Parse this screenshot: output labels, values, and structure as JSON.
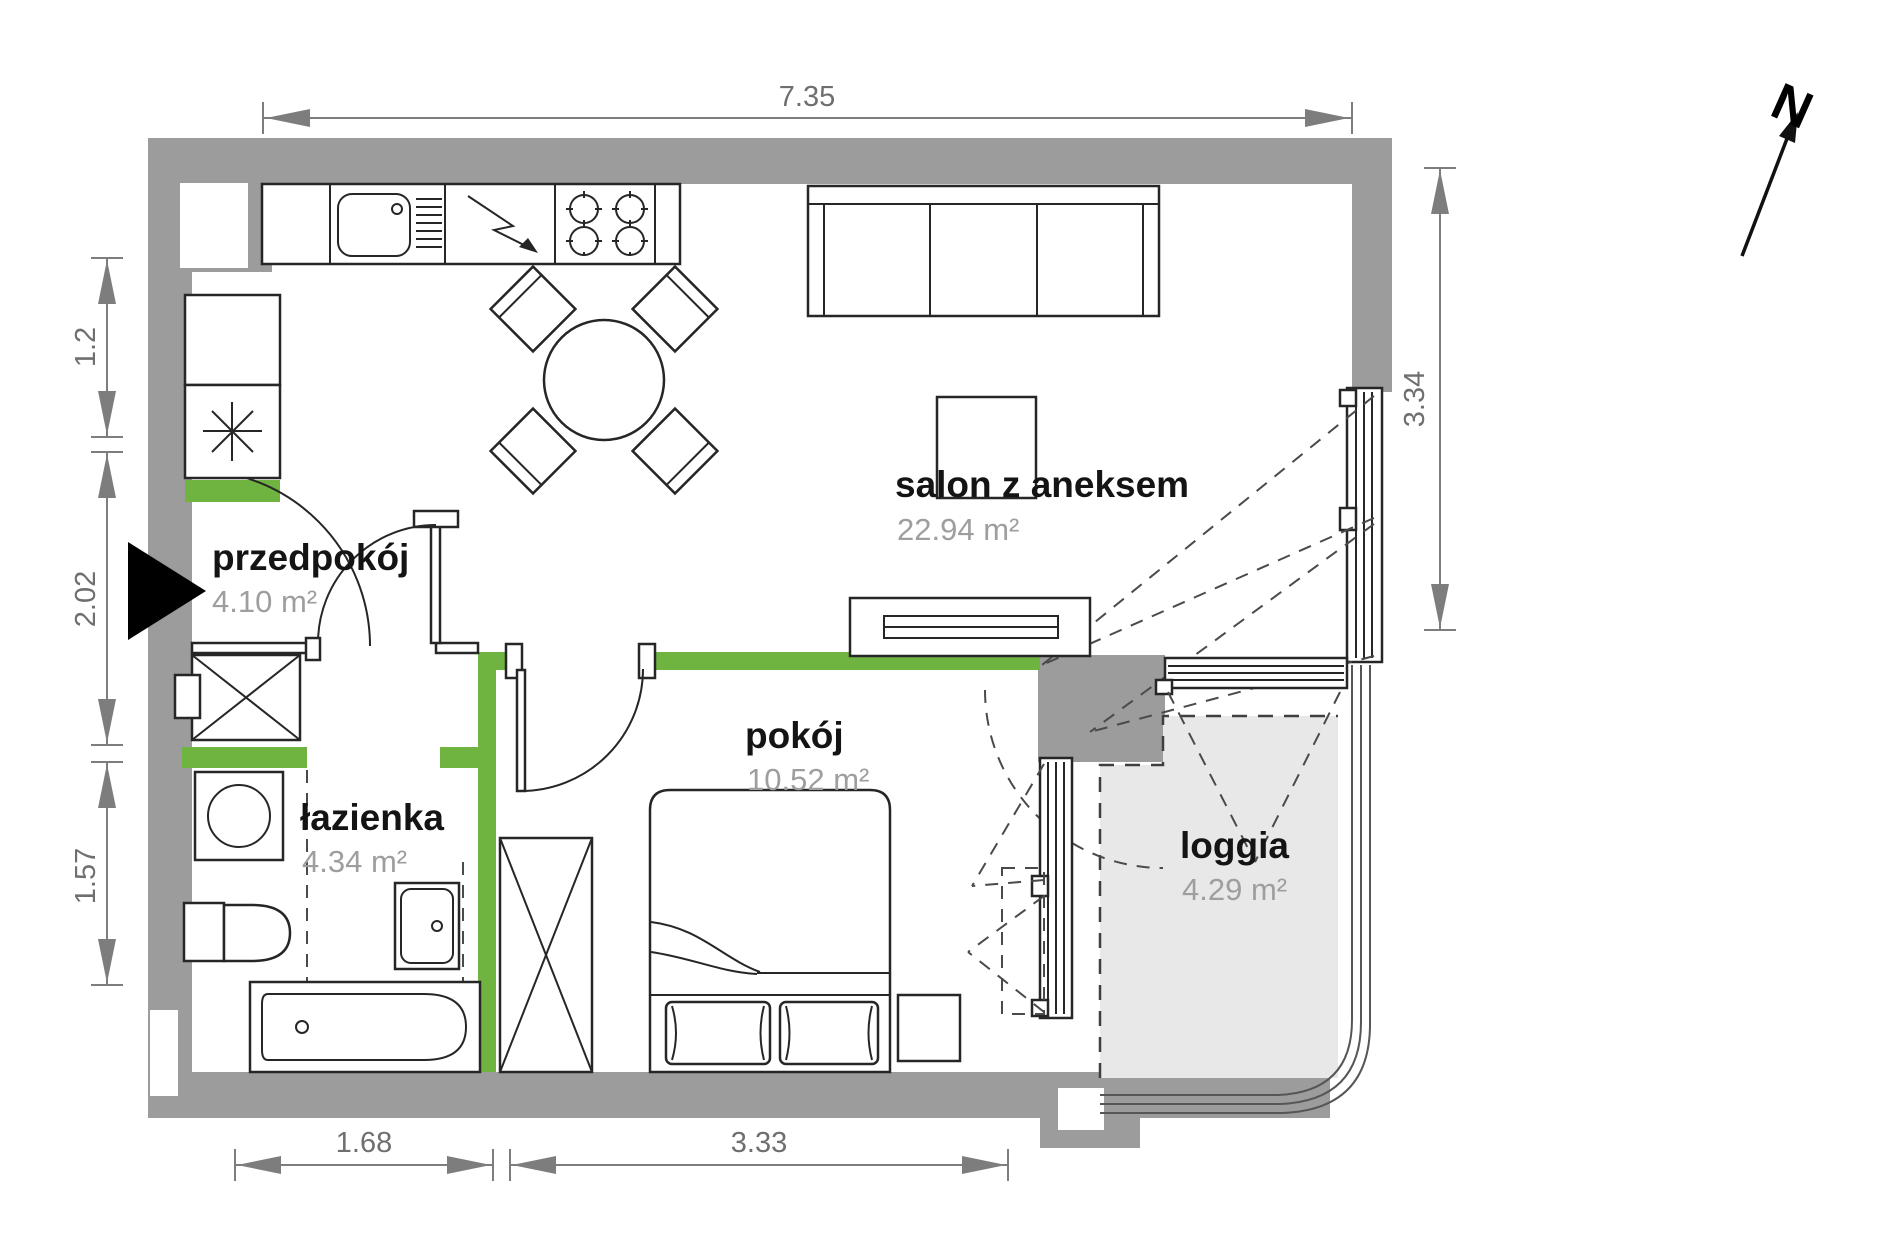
{
  "plan": {
    "rooms": [
      {
        "id": "przedpokoj",
        "name": "przedpokój",
        "area": "4.10 m²"
      },
      {
        "id": "salon",
        "name": "salon z aneksem",
        "area": "22.94 m²"
      },
      {
        "id": "pokoj",
        "name": "pokój",
        "area": "10.52 m²"
      },
      {
        "id": "lazienka",
        "name": "łazienka",
        "area": "4.34 m²"
      },
      {
        "id": "loggia",
        "name": "loggia",
        "area": "4.29 m²"
      }
    ],
    "dimensions": {
      "top": "7.35",
      "left": [
        "1.2",
        "2.02",
        "1.57"
      ],
      "right": "3.34",
      "bottom": [
        "1.68",
        "3.33"
      ]
    },
    "north_label": "N",
    "colors": {
      "wall": "#9c9c9c",
      "accent_green": "#6fb440",
      "loggia_fill": "#e8e8e8",
      "dimension_gray": "#7d7d7d",
      "line_dark": "#262626",
      "room_name_text": "#141414",
      "area_text": "#9e9e9e"
    }
  }
}
